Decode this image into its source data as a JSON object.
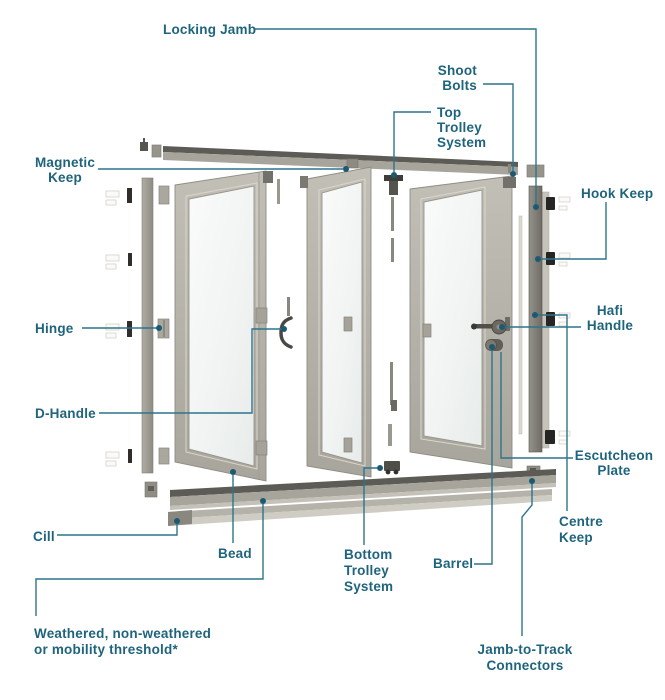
{
  "diagram": {
    "subject": "bifold-door-exploded-parts-diagram",
    "colors": {
      "label_text": "#1e647d",
      "leader_line": "#2d748c",
      "leader_dot": "#1c5a72",
      "frame_grey": "#a7a49b",
      "keep_black": "#262523",
      "glass": "#f1f4f3"
    }
  },
  "labels": {
    "locking_jamb": "Locking Jamb",
    "shoot_bolts": [
      "Shoot",
      "Bolts"
    ],
    "top_trolley_system": [
      "Top",
      "Trolley",
      "System"
    ],
    "magnetic_keep": [
      "Magnetic",
      "Keep"
    ],
    "hook_keep": "Hook Keep",
    "hinge": "Hinge",
    "hafi_handle": [
      "Hafi",
      "Handle"
    ],
    "d_handle": "D-Handle",
    "escutcheon_plate": [
      "Escutcheon",
      "Plate"
    ],
    "centre_keep": [
      "Centre",
      "Keep"
    ],
    "cill": "Cill",
    "bead": "Bead",
    "bottom_trolley_system": [
      "Bottom",
      "Trolley",
      "System"
    ],
    "barrel": "Barrel",
    "threshold": [
      "Weathered, non-weathered",
      "or mobility threshold*"
    ],
    "jamb_to_track_connectors": [
      "Jamb-to-Track",
      "Connectors"
    ]
  }
}
